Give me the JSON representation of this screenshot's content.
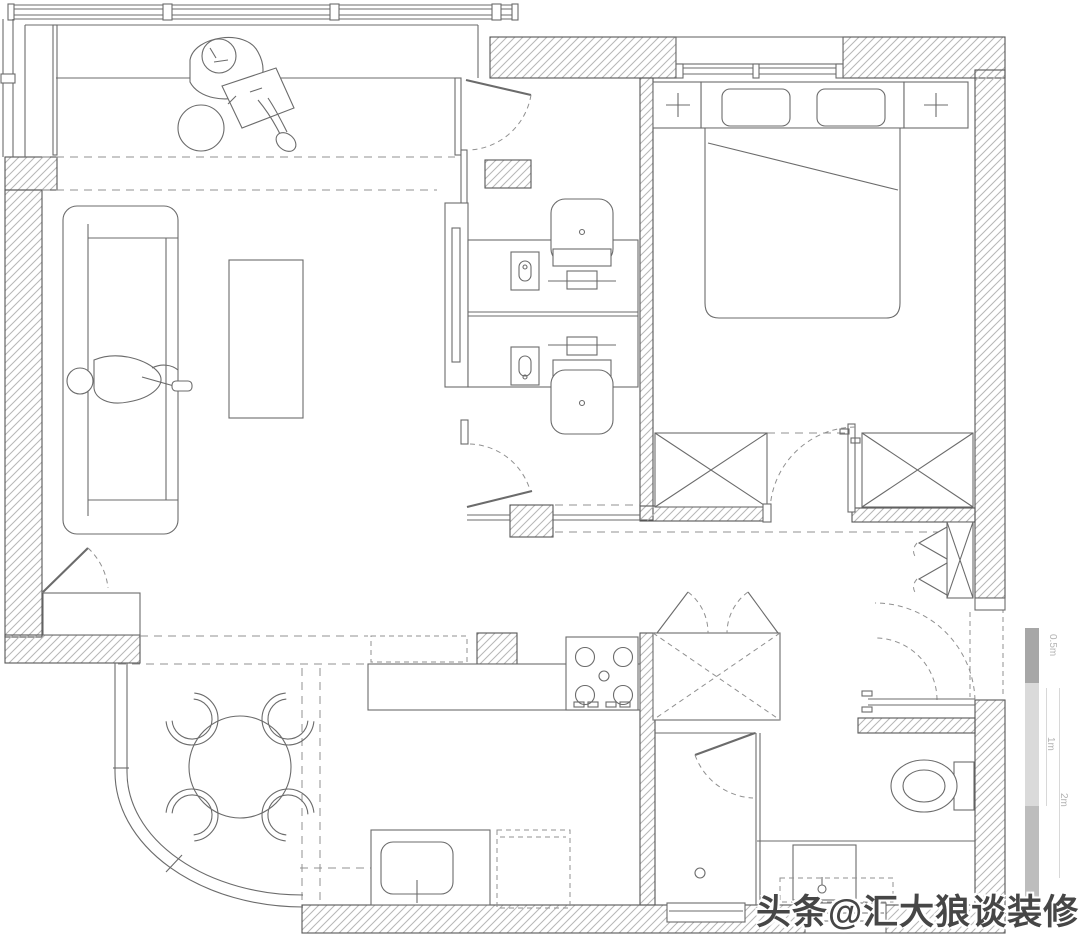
{
  "title": "apartment-floor-plan",
  "watermark": {
    "text": "头条@汇大狼谈装修"
  },
  "scale_bar": {
    "labels": [
      "0.5m",
      "1m",
      "2m"
    ]
  },
  "palette": {
    "bg": "#ffffff",
    "line": "#6b6b6b",
    "wall": "#565656",
    "hatch": "#b6b6b6",
    "dash": "#909090",
    "watermark": "#464646",
    "scale1": "#a7a7a7",
    "scale2": "#dadada",
    "scale3": "#bdbdbd",
    "scale_label": "#b3b3b3",
    "scale_rule": "#d8d8d8"
  }
}
